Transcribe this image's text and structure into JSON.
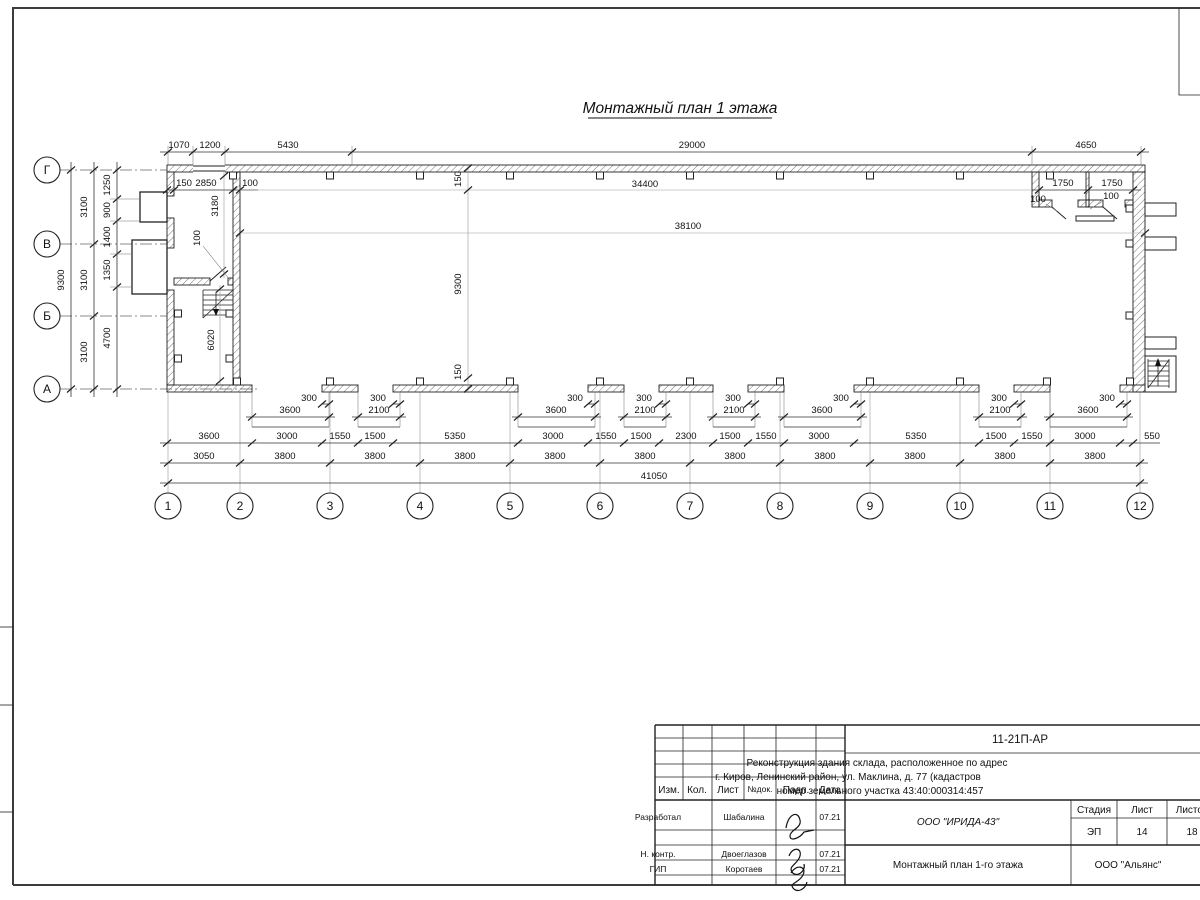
{
  "title": "Монтажный план 1 этажа",
  "axes": {
    "rows": [
      "Г",
      "В",
      "Б",
      "А"
    ],
    "cols": [
      "1",
      "2",
      "3",
      "4",
      "5",
      "6",
      "7",
      "8",
      "9",
      "10",
      "11",
      "12"
    ]
  },
  "dims": {
    "top": [
      "1070",
      "1200",
      "5430",
      "29000",
      "4650"
    ],
    "inner_left": [
      "150",
      "2850",
      "100"
    ],
    "hall_width_upper": "34400",
    "rooms_right": [
      "1750",
      "1750"
    ],
    "hall_width_lower": "38100",
    "wall_thickness": "100",
    "mid_vertical": [
      "150",
      "9300",
      "150"
    ],
    "left_total": "9300",
    "left_thirds": [
      "3100",
      "3100",
      "3100"
    ],
    "left_inner": [
      "1250",
      "900",
      "1400",
      "1350",
      "4700"
    ],
    "annex_vertical": [
      "3180",
      "6020"
    ],
    "gates": [
      "3600",
      "2100",
      "3600",
      "2100",
      "2100",
      "3600",
      "2100",
      "3600"
    ],
    "gate_jamb": "300",
    "openings_row": [
      "3600",
      "3000",
      "1550",
      "1500",
      "5350",
      "3000",
      "1550",
      "1500",
      "2300",
      "1500",
      "1550",
      "3000",
      "5350",
      "1500",
      "1550",
      "3000",
      "550"
    ],
    "axes_row": [
      "3050",
      "3800",
      "3800",
      "3800",
      "3800",
      "3800",
      "3800",
      "3800",
      "3800",
      "3800",
      "3800"
    ],
    "total": "41050"
  },
  "titleblock": {
    "code": "11-21П-АР",
    "desc1": "Реконструкция здания склада, расположенное по адрес",
    "desc2": "г. Киров, Ленинский район, ул. Маклина, д. 77 (кадастров",
    "desc3": "номер земельного участка 43:40:000314:457",
    "cols": [
      "Изм.",
      "Кол.",
      "Лист",
      "№док.",
      "Подп.",
      "Дата"
    ],
    "rows": [
      {
        "role": "Разработал",
        "name": "Шабалина",
        "date": "07.21"
      },
      {
        "role": "Н. контр.",
        "name": "Двоеглазов",
        "date": "07.21"
      },
      {
        "role": "ГИП",
        "name": "Коротаев",
        "date": "07.21"
      }
    ],
    "org": "ООО \"ИРИДА-43\"",
    "sheet_name": "Монтажный план 1-го этажа",
    "stage_label": "Стадия",
    "sheet_label": "Лист",
    "sheets_label": "Листов",
    "stage": "ЭП",
    "sheet_num": "14",
    "sheets_total": "18",
    "company": "ООО \"Альянс\""
  }
}
